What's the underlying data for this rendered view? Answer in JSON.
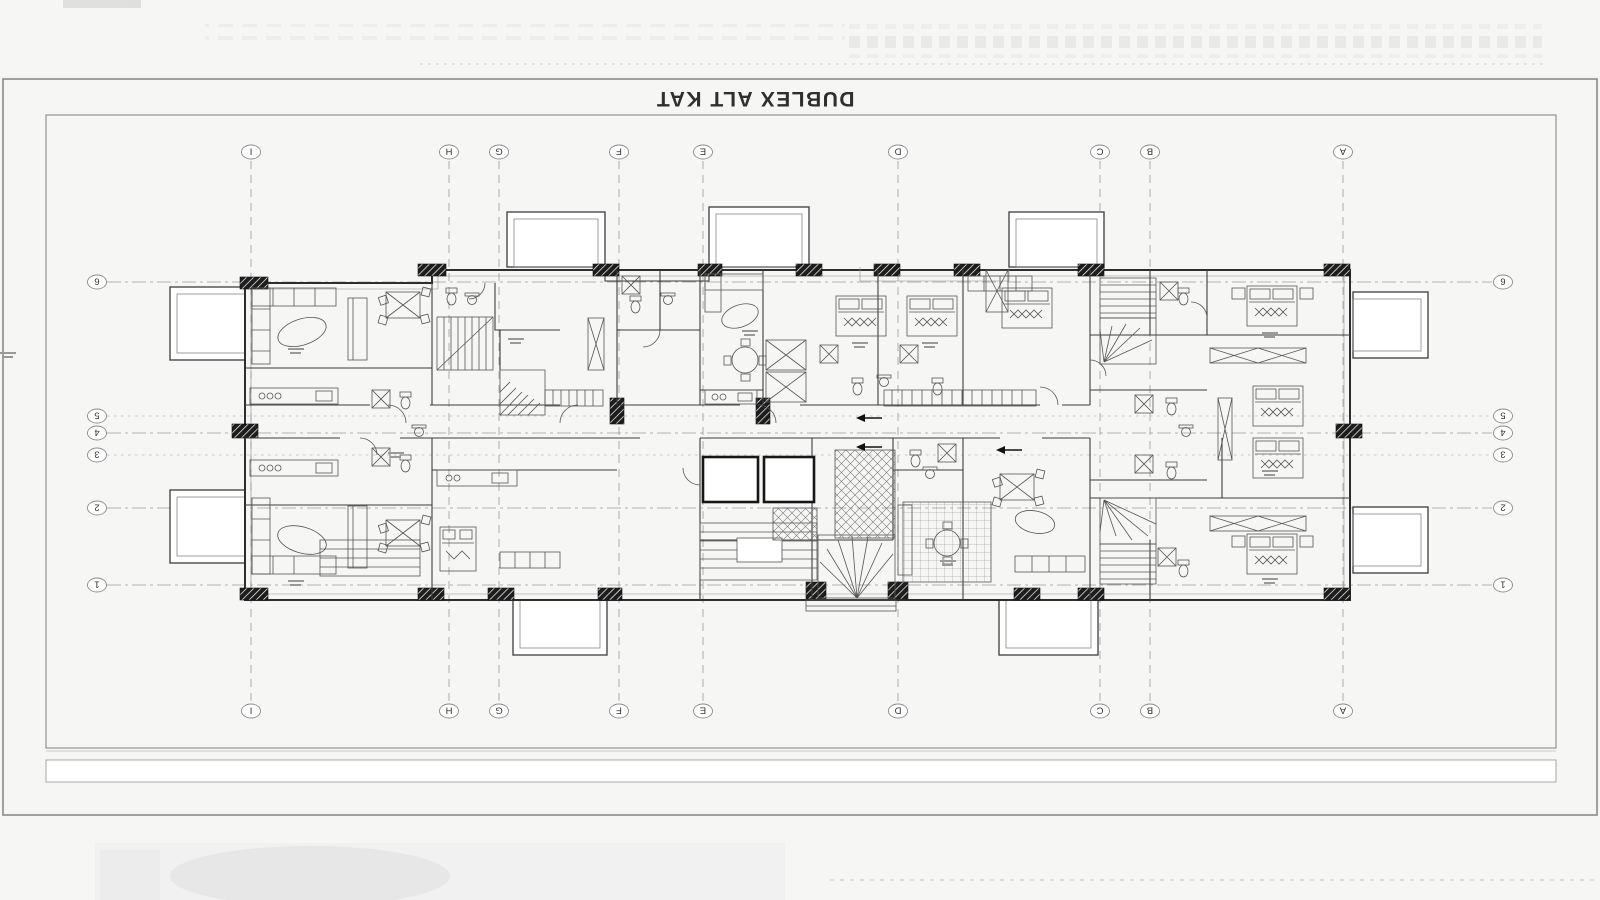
{
  "title": "DUBLEX ALT KAT",
  "sheet": {
    "type": "architectural floor plan (drawing rotated 180°)",
    "grid": {
      "columns": [
        "I",
        "H",
        "G",
        "F",
        "E",
        "D",
        "C",
        "B",
        "A"
      ],
      "rows": [
        "6",
        "5",
        "4",
        "3",
        "2",
        "1"
      ]
    },
    "colors": {
      "background": "#f6f6f5",
      "paper": "#ffffff",
      "line": "#2e2e2e",
      "grid_line": "#9a9a9a",
      "frame": "#8a8a8a"
    }
  }
}
